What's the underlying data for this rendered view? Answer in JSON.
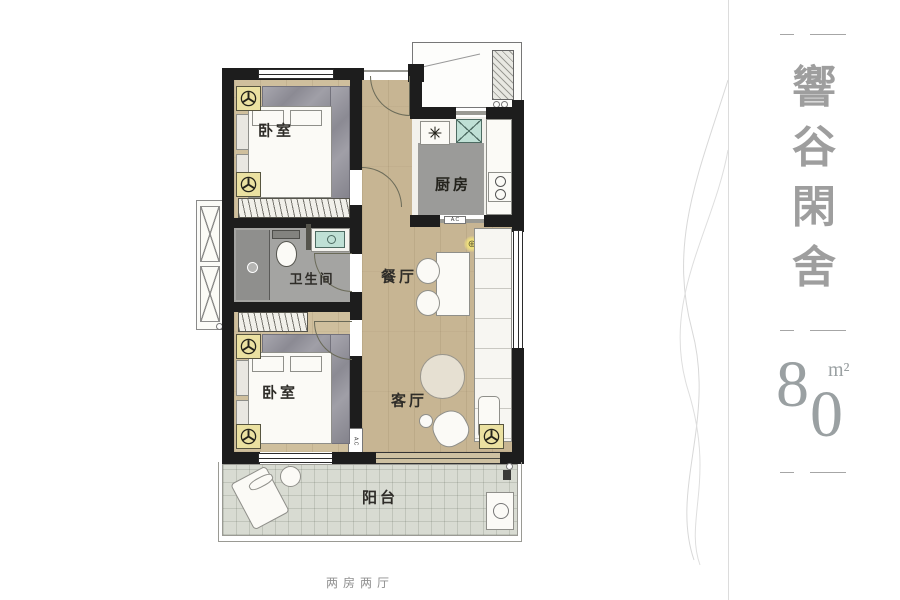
{
  "plan": {
    "labels": {
      "bedroom_top": "卧室",
      "kitchen": "厨房",
      "bathroom": "卫生间",
      "dining": "餐厅",
      "bedroom_bottom": "卧室",
      "living": "客厅",
      "balcony": "阳台",
      "ac_kitchen": "A.C",
      "ac_bedroom": "A.C"
    },
    "colors": {
      "wall": "#1d1d1d",
      "wood_floor": "#c7b593",
      "balcony_tile": "#d8dbd2",
      "bathroom_floor": "#a4a4a2",
      "kitchen_rug": "#9b9b99",
      "fan_symbol_bg": "#ebe1a1",
      "basin_teal": "#bfe0d5",
      "marble_gray": "#94939c",
      "label_ink": "#2e2c28"
    }
  },
  "side_panel": {
    "title_chars": [
      "響",
      "谷",
      "閑",
      "舍"
    ],
    "area": {
      "digit_top": "8",
      "digit_bottom": "0",
      "unit": "m²"
    },
    "text_gray": "#9e9e9e"
  },
  "caption": "两房两厅"
}
